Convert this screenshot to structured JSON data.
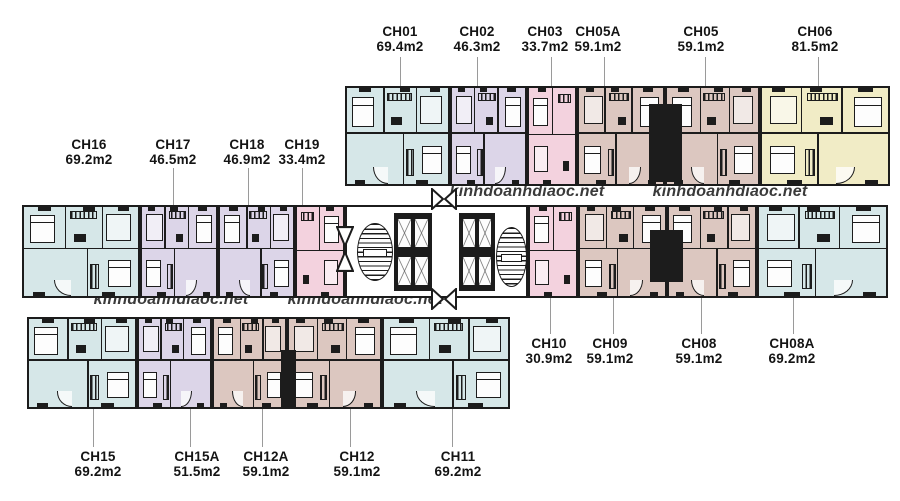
{
  "palette": {
    "wall": "#1c1c1c",
    "cyan": "#d6e7e8",
    "lavender": "#dcd5e8",
    "pink": "#f3d2de",
    "rose": "#dcc7c0",
    "yellow": "#f1ecc6",
    "watermark_color": "#3a3a3a",
    "leader_color": "#9a9a9a"
  },
  "watermarks": [
    {
      "text": "kinhdoanhdiaoc.net"
    },
    {
      "text": "kinhdoanhdiaoc.net"
    },
    {
      "text": "kinhdoanhdiaoc.net"
    },
    {
      "text": "kinhdoanhdiaoc.net"
    }
  ],
  "units": [
    {
      "id": "CH01",
      "area": "69.4m2",
      "color": "cyan"
    },
    {
      "id": "CH02",
      "area": "46.3m2",
      "color": "lavender"
    },
    {
      "id": "CH03",
      "area": "33.7m2",
      "color": "pink"
    },
    {
      "id": "CH05A",
      "area": "59.1m2",
      "color": "rose"
    },
    {
      "id": "CH05",
      "area": "59.1m2",
      "color": "rose"
    },
    {
      "id": "CH06",
      "area": "81.5m2",
      "color": "yellow"
    },
    {
      "id": "CH16",
      "area": "69.2m2",
      "color": "cyan"
    },
    {
      "id": "CH17",
      "area": "46.5m2",
      "color": "lavender"
    },
    {
      "id": "CH18",
      "area": "46.9m2",
      "color": "lavender"
    },
    {
      "id": "CH19",
      "area": "33.4m2",
      "color": "pink"
    },
    {
      "id": "CH10",
      "area": "30.9m2",
      "color": "pink"
    },
    {
      "id": "CH09",
      "area": "59.1m2",
      "color": "rose"
    },
    {
      "id": "CH08",
      "area": "59.1m2",
      "color": "rose"
    },
    {
      "id": "CH08A",
      "area": "69.2m2",
      "color": "cyan"
    },
    {
      "id": "CH15",
      "area": "69.2m2",
      "color": "cyan"
    },
    {
      "id": "CH15A",
      "area": "51.5m2",
      "color": "lavender"
    },
    {
      "id": "CH12A",
      "area": "59.1m2",
      "color": "rose"
    },
    {
      "id": "CH12",
      "area": "59.1m2",
      "color": "rose"
    },
    {
      "id": "CH11",
      "area": "69.2m2",
      "color": "cyan"
    }
  ]
}
